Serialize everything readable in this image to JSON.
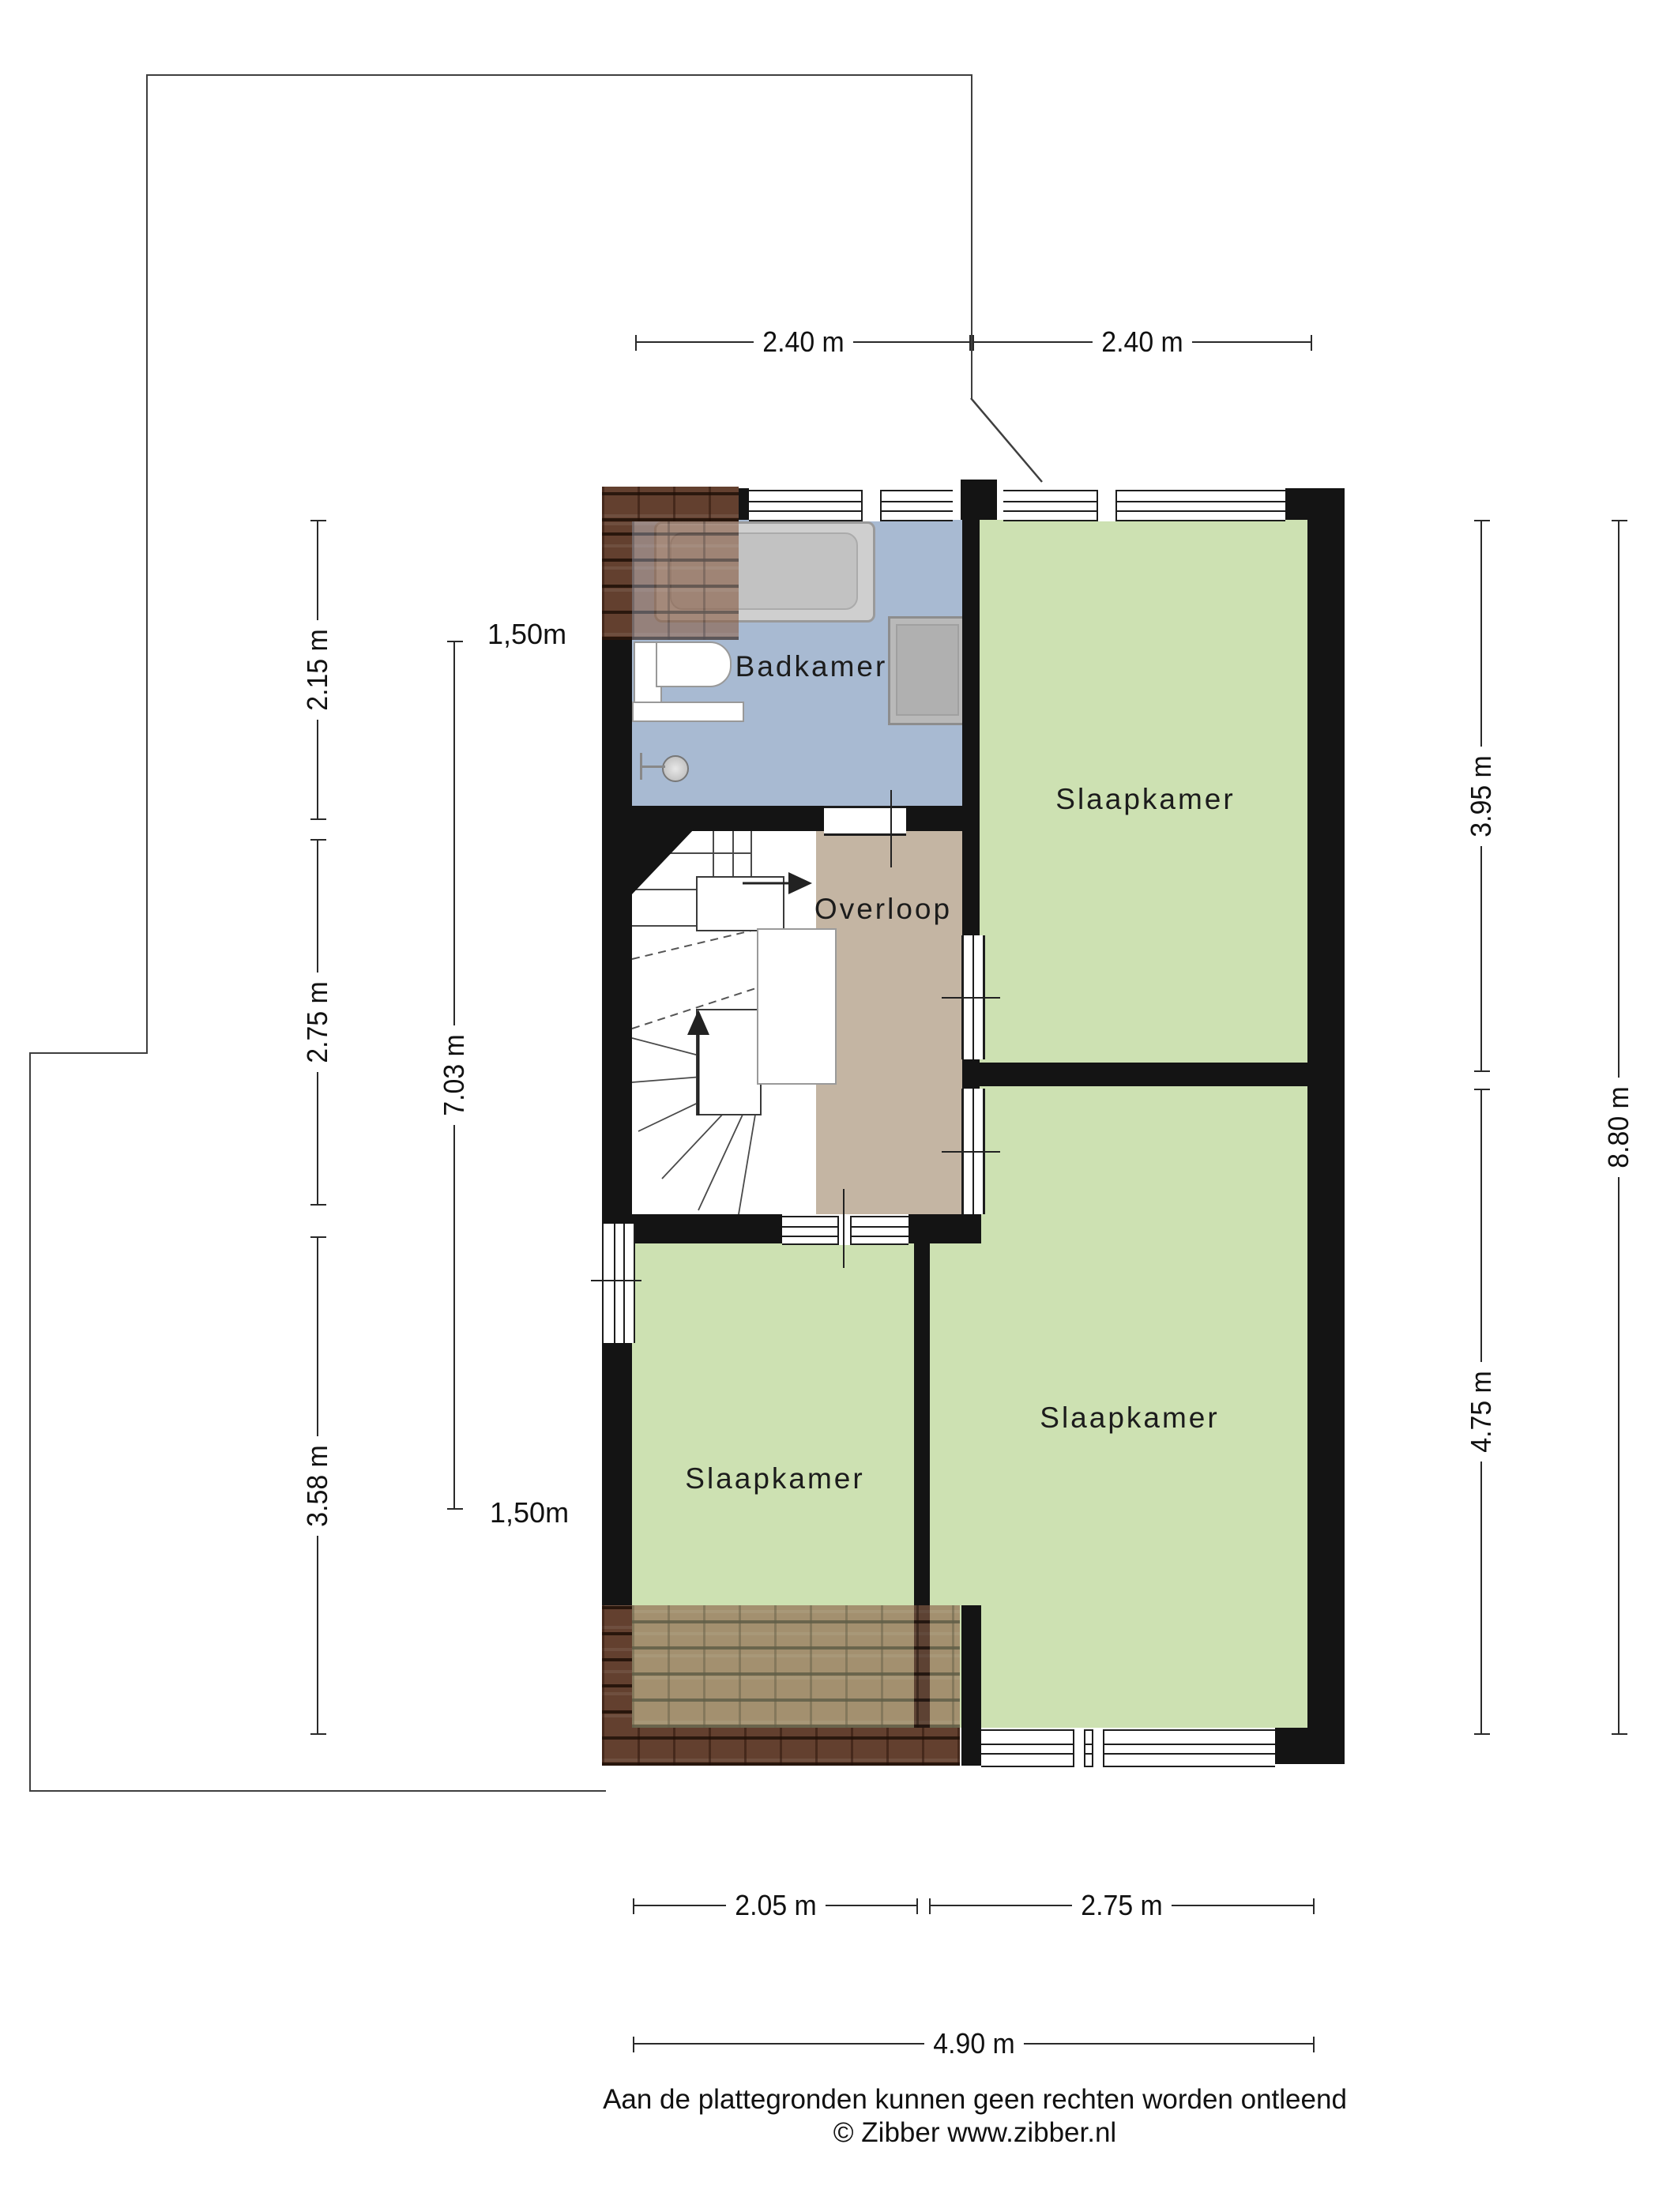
{
  "plan": {
    "rooms": {
      "badkamer": {
        "label": "Badkamer"
      },
      "overloop": {
        "label": "Overloop"
      },
      "slaapkamer_top": {
        "label": "Slaapkamer"
      },
      "slaapkamer_left": {
        "label": "Slaapkamer"
      },
      "slaapkamer_right": {
        "label": "Slaapkamer"
      }
    },
    "fixtures": [
      "bathtub",
      "toilet",
      "shelf",
      "shower-head",
      "cabinet",
      "winder-staircase"
    ]
  },
  "dimensions": {
    "top": [
      "2.40 m",
      "2.40 m"
    ],
    "left": [
      "2.15 m",
      "2.75 m",
      "3.58 m"
    ],
    "left_total": "7.03 m",
    "headroom": [
      "1,50m",
      "1,50m"
    ],
    "right": [
      "3.95 m",
      "4.75 m"
    ],
    "right_total": "8.80 m",
    "bottom": [
      "2.05 m",
      "2.75 m"
    ],
    "bottom_total": "4.90 m"
  },
  "footer": {
    "disclaimer": "Aan de plattegronden kunnen geen rechten worden ontleend",
    "credit": "© Zibber www.zibber.nl"
  },
  "colors": {
    "wall": "#141414",
    "bathroom_floor": "#a8bad2",
    "bedroom_floor": "#cde1b2",
    "landing_floor": "#c4b5a3",
    "roof_tile": "#8a5f47",
    "roof_tile_dark": "#63402f",
    "dimension_line": "#2a2a2a",
    "outline": "#3f3f3f"
  }
}
